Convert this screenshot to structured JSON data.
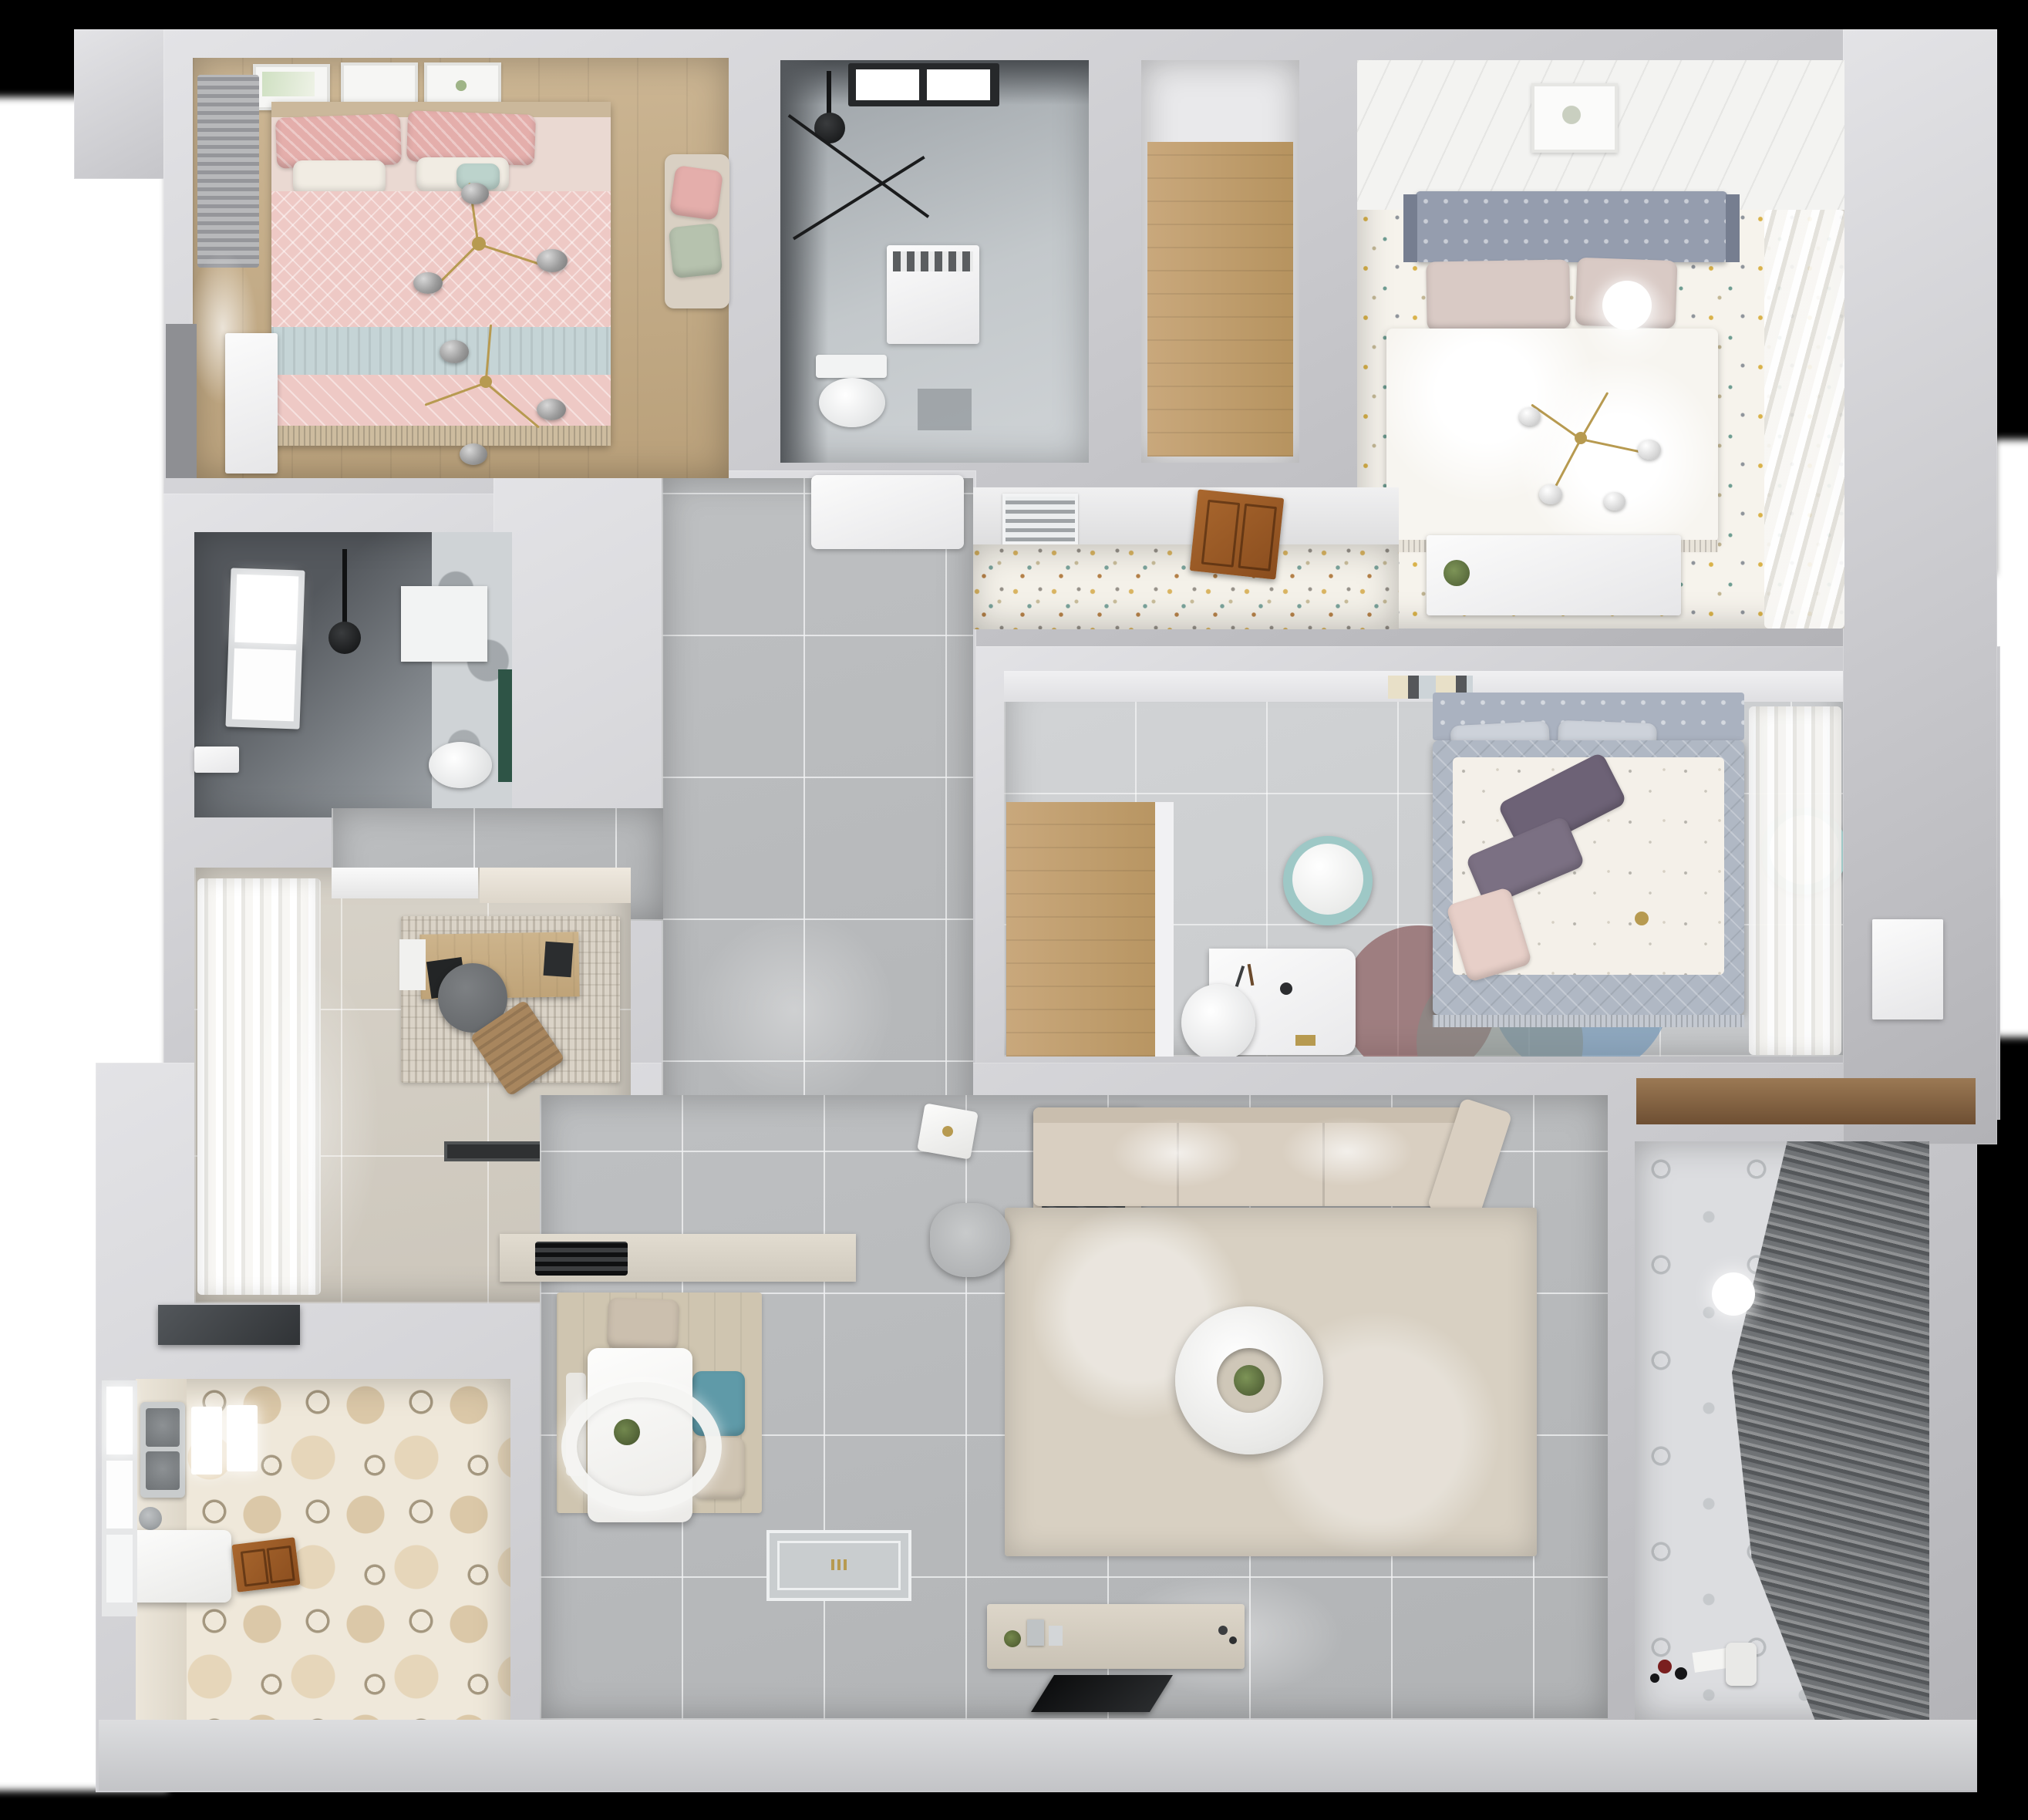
{
  "scene": {
    "type": "3d-floorplan-top-down-render",
    "style": "photoreal dollhouse view, no visible text labels",
    "background": "#000000"
  },
  "palette": {
    "bg": "#000000",
    "wall": "#c8c8cc",
    "wallLight": "#e3e3e6",
    "wallDark": "#a2a3a7",
    "woodA": "#cdb795",
    "woodB": "#b9a07a",
    "grayTile": "#b1b3b5",
    "terr": "#f4f1e9",
    "hexBase": "#efe8da",
    "hexTan": "#dbc8a8",
    "bathDark": "#54585d",
    "bathFloor": "#aeb3b7",
    "pink": "#eec9c5",
    "pinkDeep": "#e4aeab",
    "blueBlanket": "#c5d4d6",
    "cream": "#f1ece3",
    "headboardGray": "#959dae",
    "duvet": "#f7f5f0",
    "quiltBlue": "#b0b8c4",
    "purple": "#6d6276",
    "blush": "#e7cfc8",
    "teal": "#9ec8c6",
    "tealDeep": "#5f9aa8",
    "rugBeige": "#d8d0c2",
    "sofa": "#d9cfc1",
    "sofaThrow": "#4b5055",
    "woodDoor": "#9a5a28",
    "gold": "#b79a50",
    "dark": "#1d1f20",
    "green": "#5e7042",
    "balconyFloor": "#dcdde0"
  },
  "rooms": [
    {
      "id": "master-bedroom",
      "floor": "warm-wood",
      "furniture": [
        "wall-art-frames",
        "window-blinds",
        "double-bed-pink",
        "gold-chandelier",
        "armchair",
        "white-door"
      ]
    },
    {
      "id": "bathroom-main",
      "floor": "gray-marble",
      "furniture": [
        "skylight-window",
        "shower",
        "washing-machine",
        "toilet",
        "floor-drain"
      ]
    },
    {
      "id": "storage-nook",
      "floor": "wood-plank",
      "furniture": []
    },
    {
      "id": "bedroom-guest",
      "floor": "speckle-wallpaper",
      "furniture": [
        "ceiling-slats",
        "wall-art",
        "tufted-headboard-bed",
        "chandelier",
        "ceiling-lamp",
        "sheer-curtain",
        "shelf-with-plant"
      ]
    },
    {
      "id": "entry-corridor",
      "floor": "terrazzo",
      "furniture": [
        "air-vent",
        "wood-entry-door"
      ]
    },
    {
      "id": "bathroom-second",
      "floor": "dark-tile",
      "furniture": [
        "window",
        "shower-head",
        "wall-board",
        "green-accent",
        "toilet"
      ]
    },
    {
      "id": "study",
      "floor": "beige-tile",
      "furniture": [
        "sheer-curtain",
        "desk",
        "desk-chair",
        "laptop",
        "lounge-chair",
        "area-rug",
        "door-mat"
      ]
    },
    {
      "id": "hallway",
      "floor": "gray-tile",
      "furniture": [
        "white-sideboard"
      ]
    },
    {
      "id": "bedroom-middle",
      "floor": "light-tile",
      "furniture": [
        "headboard-shelf-books",
        "bed-floral-duvet",
        "purple-pillows",
        "round-rug-circles",
        "bedside-stools",
        "white-desk",
        "desk-chair",
        "wardrobe-wood-strip",
        "sheer-curtain"
      ]
    },
    {
      "id": "dining-area",
      "floor": "gray-tile",
      "furniture": [
        "counter-with-cooktop",
        "wood-mat",
        "dining-table",
        "pendant-ring-lamp",
        "chairs-beige-teal",
        "ornate-door-mat"
      ]
    },
    {
      "id": "kitchen",
      "floor": "hex-tile",
      "furniture": [
        "window",
        "double-sink",
        "light-boards",
        "island-block",
        "wood-door",
        "range-hood"
      ]
    },
    {
      "id": "living-room",
      "floor": "gray-tile",
      "furniture": [
        "sectional-sofa",
        "dark-throw",
        "armchair",
        "side-table",
        "big-rug",
        "donut-coffee-table",
        "tv-console",
        "tv-panel"
      ]
    },
    {
      "id": "balcony",
      "floor": "pattern-tile",
      "furniture": [
        "dark-blinds",
        "pendant-ball-light",
        "toys",
        "small-stool",
        "wood-niche-shelf"
      ]
    }
  ]
}
